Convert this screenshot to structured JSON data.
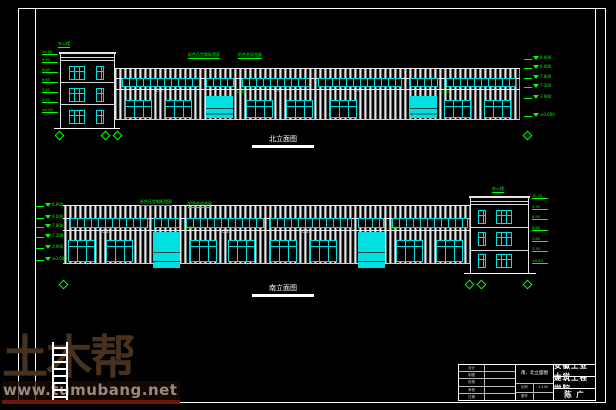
{
  "watermark": {
    "logo": "土木帮",
    "url": "www.tumubang.net"
  },
  "titleblock": {
    "school": "安徽工业大学",
    "college": "建筑工程学院",
    "author": "陈 广",
    "drawing_title": "南、北立面图",
    "fields": [
      {
        "label": "设计",
        "value": ""
      },
      {
        "label": "制图",
        "value": ""
      },
      {
        "label": "校核",
        "value": ""
      },
      {
        "label": "审核",
        "value": ""
      },
      {
        "label": "日期",
        "value": ""
      }
    ],
    "extras": [
      {
        "label": "比例",
        "value": "1:100"
      },
      {
        "label": "图号",
        "value": ""
      }
    ]
  },
  "elev_north": {
    "label": "北立面图",
    "annotations": [
      {
        "x": 18,
        "y": 2,
        "text": "办公楼"
      },
      {
        "x": 148,
        "y": 13,
        "text": "彩色压型钢板墙面"
      },
      {
        "x": 198,
        "y": 13,
        "text": "铝合金组合窗"
      }
    ],
    "strips": [
      {
        "x": 82,
        "y": 38,
        "w": 78,
        "h": 9
      },
      {
        "x": 166,
        "y": 38,
        "w": 28,
        "h": 9
      },
      {
        "x": 202,
        "y": 38,
        "w": 68,
        "h": 9
      },
      {
        "x": 278,
        "y": 38,
        "w": 84,
        "h": 9
      },
      {
        "x": 370,
        "y": 38,
        "w": 28,
        "h": 9
      },
      {
        "x": 406,
        "y": 38,
        "w": 70,
        "h": 9
      }
    ],
    "doors": [
      {
        "x": 166,
        "y": 56,
        "w": 27,
        "h": 22
      },
      {
        "x": 370,
        "y": 56,
        "w": 27,
        "h": 22
      }
    ],
    "windows": [
      {
        "x": 85,
        "y": 60,
        "w": 27,
        "h": 18
      },
      {
        "x": 125,
        "y": 60,
        "w": 27,
        "h": 18
      },
      {
        "x": 206,
        "y": 60,
        "w": 27,
        "h": 18
      },
      {
        "x": 246,
        "y": 60,
        "w": 27,
        "h": 18
      },
      {
        "x": 290,
        "y": 60,
        "w": 27,
        "h": 18
      },
      {
        "x": 404,
        "y": 60,
        "w": 27,
        "h": 18
      },
      {
        "x": 444,
        "y": 60,
        "w": 27,
        "h": 18
      }
    ],
    "owins": [
      {
        "x": 29,
        "y": 26,
        "w": 16,
        "h": 14
      },
      {
        "x": 56,
        "y": 26,
        "w": 8,
        "h": 14
      },
      {
        "x": 29,
        "y": 48,
        "w": 16,
        "h": 14
      },
      {
        "x": 56,
        "y": 48,
        "w": 8,
        "h": 14
      },
      {
        "x": 29,
        "y": 70,
        "w": 16,
        "h": 14
      },
      {
        "x": 56,
        "y": 70,
        "w": 8,
        "h": 14
      }
    ],
    "office_lines": [
      {
        "y": 4
      },
      {
        "y": 7
      },
      {
        "y": 29
      },
      {
        "y": 51
      }
    ],
    "levels": [
      {
        "y": 16,
        "text": "9.900"
      },
      {
        "y": 25,
        "text": "9.000"
      },
      {
        "y": 35,
        "text": "7.800"
      },
      {
        "y": 44,
        "text": "7.200"
      },
      {
        "y": 55,
        "text": "3.900"
      },
      {
        "y": 73,
        "text": "±0.000"
      }
    ],
    "ticks": [
      {
        "y": 14,
        "text": "10.20"
      },
      {
        "y": 22,
        "text": "9.90"
      },
      {
        "y": 32,
        "text": "6.90"
      },
      {
        "y": 42,
        "text": "6.60"
      },
      {
        "y": 52,
        "text": "3.60"
      },
      {
        "y": 62,
        "text": "3.30"
      },
      {
        "y": 72,
        "text": "±0.00"
      }
    ],
    "bubbles": [
      {
        "x": 16
      },
      {
        "x": 62
      },
      {
        "x": 74
      },
      {
        "x": 484
      }
    ],
    "band_labels": [
      {
        "x": 116,
        "y": 49,
        "text": "C-2"
      },
      {
        "x": 234,
        "y": 49,
        "text": "C-2"
      },
      {
        "x": 314,
        "y": 49,
        "text": "C-2"
      }
    ],
    "door_notes": [
      {
        "x": 196,
        "y": 51,
        "text": "3.000"
      },
      {
        "x": 400,
        "y": 51,
        "text": "3.000"
      }
    ]
  },
  "elev_south": {
    "label": "南立面图",
    "annotations": [
      {
        "x": 100,
        "y": 15,
        "text": "彩色压型钢板墙面"
      },
      {
        "x": 148,
        "y": 17,
        "text": "铝合金组合窗"
      },
      {
        "x": 452,
        "y": 2,
        "text": "办公楼"
      }
    ],
    "strips": [
      {
        "x": 30,
        "y": 33,
        "w": 78,
        "h": 10
      },
      {
        "x": 114,
        "y": 33,
        "w": 26,
        "h": 10
      },
      {
        "x": 146,
        "y": 33,
        "w": 78,
        "h": 10
      },
      {
        "x": 230,
        "y": 33,
        "w": 82,
        "h": 10
      },
      {
        "x": 318,
        "y": 33,
        "w": 26,
        "h": 10
      },
      {
        "x": 352,
        "y": 33,
        "w": 76,
        "h": 10
      }
    ],
    "doors": [
      {
        "x": 113,
        "y": 47,
        "w": 27,
        "h": 36
      },
      {
        "x": 318,
        "y": 47,
        "w": 27,
        "h": 36
      }
    ],
    "windows": [
      {
        "x": 28,
        "y": 55,
        "w": 27,
        "h": 22
      },
      {
        "x": 66,
        "y": 55,
        "w": 27,
        "h": 22
      },
      {
        "x": 150,
        "y": 55,
        "w": 27,
        "h": 22
      },
      {
        "x": 188,
        "y": 55,
        "w": 27,
        "h": 22
      },
      {
        "x": 230,
        "y": 55,
        "w": 27,
        "h": 22
      },
      {
        "x": 270,
        "y": 55,
        "w": 27,
        "h": 22
      },
      {
        "x": 356,
        "y": 55,
        "w": 27,
        "h": 22
      },
      {
        "x": 396,
        "y": 55,
        "w": 27,
        "h": 22
      }
    ],
    "owins": [
      {
        "x": 438,
        "y": 25,
        "w": 8,
        "h": 14
      },
      {
        "x": 456,
        "y": 25,
        "w": 16,
        "h": 14
      },
      {
        "x": 438,
        "y": 47,
        "w": 8,
        "h": 14
      },
      {
        "x": 456,
        "y": 47,
        "w": 16,
        "h": 14
      },
      {
        "x": 438,
        "y": 69,
        "w": 8,
        "h": 14
      },
      {
        "x": 456,
        "y": 69,
        "w": 16,
        "h": 14
      }
    ],
    "office_lines": [
      {
        "y": 4
      },
      {
        "y": 7
      },
      {
        "y": 30
      },
      {
        "y": 53
      }
    ],
    "levels": [
      {
        "y": 18,
        "text": "9.900"
      },
      {
        "y": 30,
        "text": "9.000"
      },
      {
        "y": 39,
        "text": "7.800"
      },
      {
        "y": 49,
        "text": "7.200"
      },
      {
        "y": 60,
        "text": "3.900"
      },
      {
        "y": 72,
        "text": "±0.000"
      }
    ],
    "ticks": [
      {
        "y": 13,
        "text": "10.20"
      },
      {
        "y": 24,
        "text": "9.90"
      },
      {
        "y": 34,
        "text": "6.90"
      },
      {
        "y": 45,
        "text": "6.60"
      },
      {
        "y": 56,
        "text": "3.60"
      },
      {
        "y": 66,
        "text": "3.30"
      },
      {
        "y": 78,
        "text": "±0.00"
      }
    ],
    "bubbles": [
      {
        "x": 20
      },
      {
        "x": 426
      },
      {
        "x": 438
      },
      {
        "x": 484
      }
    ],
    "band_labels": [
      {
        "x": 62,
        "y": 45,
        "text": "C-2"
      },
      {
        "x": 182,
        "y": 45,
        "text": "C-2"
      },
      {
        "x": 262,
        "y": 45,
        "text": "C-2"
      }
    ],
    "door_notes": [
      {
        "x": 143,
        "y": 42,
        "text": "3.000"
      },
      {
        "x": 348,
        "y": 42,
        "text": "3.000"
      }
    ]
  }
}
